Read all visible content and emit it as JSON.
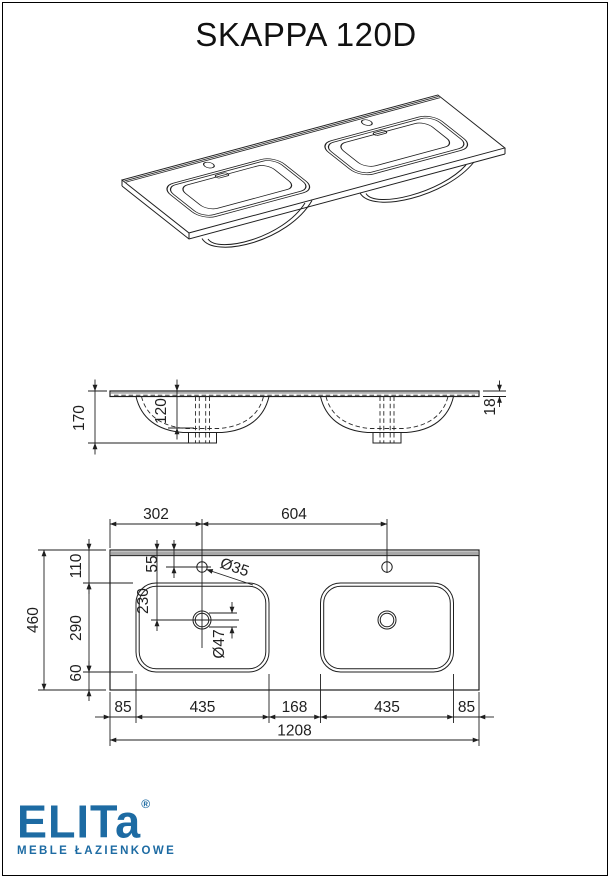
{
  "page": {
    "title": "SKAPPA 120D"
  },
  "logo": {
    "brand": "ELITa",
    "registered": "®",
    "tagline": "MEBLE ŁAZIENKOWE",
    "color": "#1d6ba3"
  },
  "front_view": {
    "overall_height": "170",
    "bowl_depth": "120",
    "top_thickness": "18"
  },
  "top_view": {
    "hole1_offset": "302",
    "hole_spacing": "604",
    "back_margin": "110",
    "hole_to_basin": "55",
    "drain_offset": "230",
    "basin_depth": "290",
    "front_margin": "60",
    "total_depth": "460",
    "faucet_hole_dia": "Ø35",
    "drain_hole_dia": "Ø47",
    "bottom_chain": [
      "85",
      "435",
      "168",
      "435",
      "85"
    ],
    "total_width": "1208"
  },
  "colors": {
    "line": "#1f1f1f",
    "edge_band_gray": "#a8a8a8",
    "logo_blue": "#1d6ba3"
  }
}
